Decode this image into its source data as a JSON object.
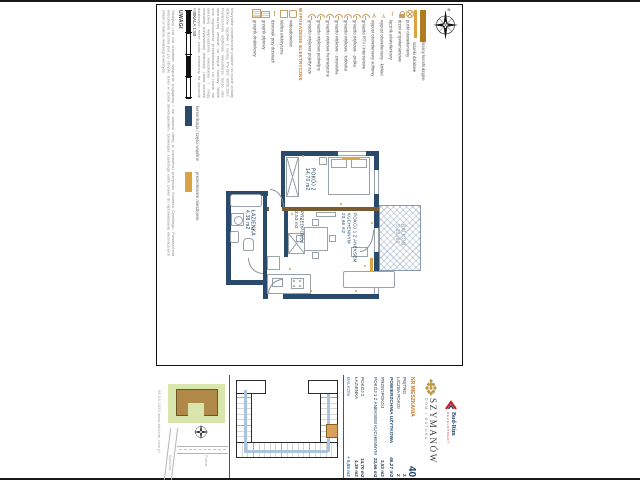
{
  "sheet": {
    "notes_title": "UWAGI",
    "notes_col1": "Niniejszy rzut ma charakter wyłącznie poglądowy i nie stanowi oferty w rozumieniu przepisów Kodeksu Cywilnego. Powierzchnia mieszkania liczona jest po obrysie ścian w stanie deweloperskim. Deweloper zastrzega sobie prawo do wprowadzania nieznacznych zmian w trakcie realizacji inwestycji.",
    "notes_col2": "Wszystkie powierzchnie podane na rzucie zostały obliczone zgodnie z normą PN-ISO 9836:1997. Powierzchnia użytkowa mieszkania może ulec nieznacznej zmianie na etapie budowy. Meble oraz wyposażenie przedstawione na rzucie nie stanowią wyposażenia mieszkania i mają charakter przykładowej aranżacji. Układ ścianek działowych może zostać zmieniony na życzenie klienta.",
    "scale_label": "SKALA 1:50",
    "swatches": [
      {
        "label": "komunikacja / części wspólne",
        "color": "#2a4a6b"
      },
      {
        "label": "prezentowane mieszkanie",
        "color": "#d9a441"
      }
    ]
  },
  "legend": {
    "header": "WYPOSAŻENIE ELEKTRYCZNE",
    "items": [
      {
        "icon": "radiator-ladder",
        "label": "grzejnik drabinkowy"
      },
      {
        "icon": "radiator-panel",
        "label": "grzejnik płytowy"
      },
      {
        "icon": "doorbell",
        "label": "dzwonek przy drzwiach"
      },
      {
        "icon": "electrical-panel",
        "label": "tablica elektryczna"
      },
      {
        "icon": "intercom",
        "label": "wideodomofon"
      },
      {
        "icon": "socket-single",
        "label": "gniazdo wtykowe pojedyncze"
      },
      {
        "icon": "socket-double",
        "label": "gniazdo wtykowe podwójne"
      },
      {
        "icon": "socket-sealed",
        "label": "gniazdo wtykowe hermetyczne"
      },
      {
        "icon": "socket-dishwasher",
        "label": "gniazdo wtykowe - zmywarka"
      },
      {
        "icon": "socket-fridge",
        "label": "gniazdo wtykowe - lodówka"
      },
      {
        "icon": "socket-washer",
        "label": "gniazdo wtykowe - pralka"
      },
      {
        "icon": "socket-rtv",
        "label": "gniazdo RTV / internetowe"
      },
      {
        "icon": "light-ceiling",
        "label": "wypust oświetleniowy sufitowy"
      },
      {
        "icon": "light-wall",
        "label": "wypust oświetleniowy - kinkiet"
      },
      {
        "icon": "light-switch",
        "label": "łącznik oświetleniowy"
      },
      {
        "icon": "security-door",
        "label": "drzwi antywłamaniowe"
      },
      {
        "icon": "light-point",
        "label": "punkt oświetleniowy"
      }
    ],
    "bars": [
      {
        "label": "ścianki działowe",
        "color": "#d9a441"
      },
      {
        "label": "ściany konstrukcyjne",
        "color": "#b07c22"
      }
    ]
  },
  "plan": {
    "rooms": [
      {
        "name": "POKÓJ 2",
        "area": "14,70 m2"
      },
      {
        "name": "ŁAZIENKA",
        "area": "4,38 m2"
      },
      {
        "name": "PRZEDPOKÓJ",
        "area": "3,53 m2"
      },
      {
        "name": "POKÓJ 1 Z ANEKSEM KUCHENNYM",
        "area": "23,66 m2"
      },
      {
        "name": "BALKON",
        "area": "5,85 m2"
      }
    ]
  },
  "site": {
    "date_and_url": "08.05.2025   www.bud-rim.com.pl",
    "street1": "Szkolna",
    "street2": "Polna"
  },
  "info": {
    "number_label": "NR MIESZKANIA",
    "number": "40",
    "floor_label": "PIĘTRO",
    "floor_value": "2",
    "rooms_count_label": "LICZBA POKOI",
    "rooms_count_value": "2",
    "area_label": "POWIERZCHNIA UŻYTKOWA",
    "area_value": "46,27 m2",
    "rooms": [
      {
        "label": "PRZEDPOKÓJ",
        "value": "3,53 m2"
      },
      {
        "label": "POKÓJ 1 Z ANEKSEM KUCHENNYM",
        "value": "23,66 m2"
      },
      {
        "label": "POKÓJ 2",
        "value": "14,70 m2"
      },
      {
        "label": "ŁAZIENKA",
        "value": "4,38 m2"
      }
    ],
    "balcony_label": "BALKON",
    "balcony_value": "+ 5,85 m2"
  },
  "brand": {
    "project": "SZYMANÓW",
    "tagline": "DOM I NATURA",
    "developer": "Bud-Rim",
    "developer_sub": "DEVELOPMENT"
  },
  "compass": {
    "north": "N"
  }
}
